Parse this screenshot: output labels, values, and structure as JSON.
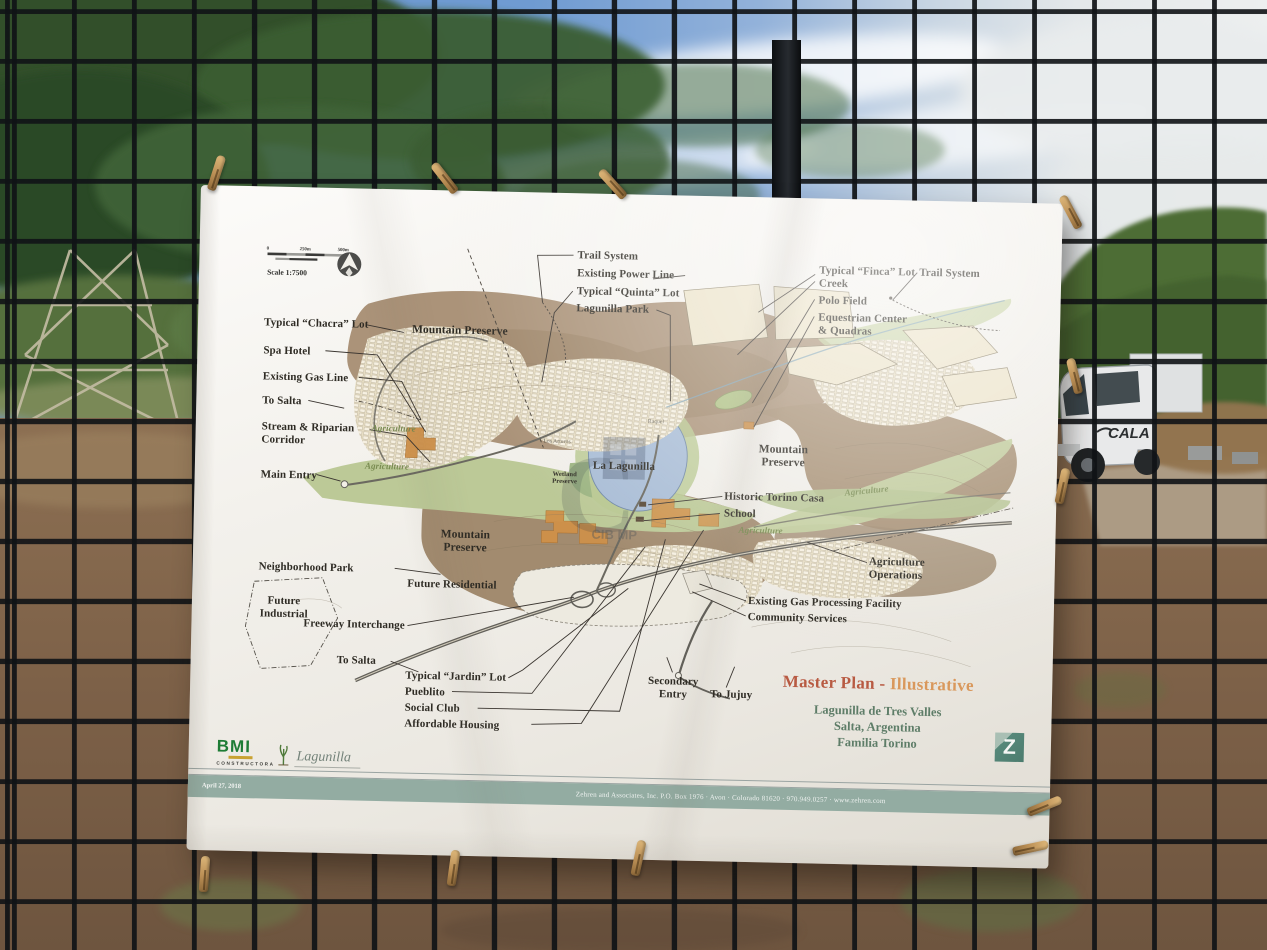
{
  "scene": {
    "truck_label": "CALA"
  },
  "poster": {
    "scale": {
      "label": "Scale 1:7500",
      "t0": "0",
      "t1": "250m",
      "t2": "500m"
    },
    "watermark": "CIB MP",
    "callouts": {
      "chacra": "Typical “Chacra” Lot",
      "spa_hotel": "Spa Hotel",
      "gas_line": "Existing Gas Line",
      "to_salta_upper": "To Salta",
      "stream": "Stream & Riparian\nCorridor",
      "main_entry": "Main Entry",
      "neighborhood_park": "Neighborhood Park",
      "future_industrial": "Future\nIndustrial",
      "freeway": "Freeway Interchange",
      "to_salta_lower": "To Salta",
      "trail_top": "Trail System",
      "power_line": "Existing Power Line",
      "quinta": "Typical “Quinta” Lot",
      "lagunilla_park": "Lagunilla Park",
      "finca": "Typical “Finca” Lot\nCreek",
      "polo": "Polo Field",
      "equestrian": "Equestrian Center\n& Quadras",
      "trail_right": "Trail System",
      "historic": "Historic Torino Casa",
      "school": "School",
      "ag_ops": "Agriculture\nOperations",
      "gas_facility": "Existing Gas Processing Facility",
      "community": "Community Services",
      "jardin": "Typical “Jardin” Lot",
      "pueblito": "Pueblito",
      "social_club": "Social Club",
      "affordable": "Affordable Housing",
      "secondary_entry": "Secondary\nEntry",
      "to_jujuy": "To Jujuy"
    },
    "area_labels": {
      "mtn_top": "Mountain Preserve",
      "mtn_right": "Mountain\nPreserve",
      "mtn_bottom": "Mountain\nPreserve",
      "future_res": "Future Residential",
      "la_lagunilla": "La Lagunilla",
      "wetland": "Wetland\nPreserve",
      "raquel": "Raquel",
      "los_arturos": "Los Arturos",
      "agriculture": "Agriculture"
    },
    "title_block": {
      "title_1": "Master Plan - ",
      "title_2": "Illustrative",
      "line1": "Lagunilla de Tres Valles",
      "line2": "Salta, Argentina",
      "line3": "Familia Torino",
      "z_letter": "Z"
    },
    "footer": {
      "bmi": "BMI",
      "bmi_sub": "CONSTRUCTORA",
      "lagunilla": "Lagunilla",
      "date": "April 27, 2018",
      "credit": "Zehren and Associates, Inc.  P.O. Box 1976 · Avon · Colorado 81620 · 970.949.0257 · www.zehren.com"
    }
  }
}
